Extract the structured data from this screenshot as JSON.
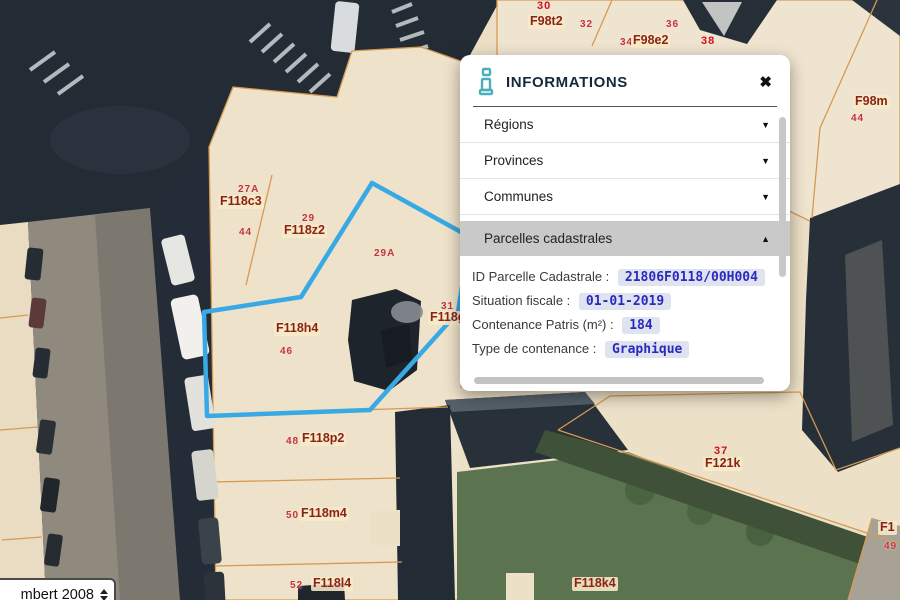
{
  "theme": {
    "selection_blue": "#38a9e4",
    "parcel_line": "#d69a52",
    "label_code_color": "#8b2219",
    "label_num_color": "#c23345",
    "panel_section_active_bg": "#c9c9c9",
    "badge_bg": "#dfe3f0",
    "badge_text": "#2a2abc",
    "info_icon_color": "#4aafbc"
  },
  "panel": {
    "title": "INFORMATIONS",
    "close_label": "✖",
    "sections": [
      {
        "label": "Régions",
        "state": "collapsed",
        "caret": "▼"
      },
      {
        "label": "Provinces",
        "state": "collapsed",
        "caret": "▼"
      },
      {
        "label": "Communes",
        "state": "collapsed",
        "caret": "▼"
      },
      {
        "label": "Parcelles cadastrales",
        "state": "expanded",
        "caret": "▲"
      }
    ],
    "details": [
      {
        "label": "ID Parcelle Cadastrale :",
        "value": "21806F0118/00H004"
      },
      {
        "label": "Situation fiscale :",
        "value": "01-01-2019"
      },
      {
        "label": "Contenance Patris (m²) :",
        "value": "184"
      },
      {
        "label": "Type de contenance :",
        "value": "Graphique"
      }
    ]
  },
  "map": {
    "projection_selector": {
      "value": "mbert 2008"
    },
    "selected_parcel_id": "21806F0118/00H004",
    "labels": [
      {
        "text": "30",
        "x": 537,
        "y": 0,
        "type": "num-bright"
      },
      {
        "text": "F98t2",
        "x": 528,
        "y": 15,
        "type": "code"
      },
      {
        "text": "32",
        "x": 580,
        "y": 19,
        "type": "num"
      },
      {
        "text": "36",
        "x": 666,
        "y": 19,
        "type": "num"
      },
      {
        "text": "34",
        "x": 620,
        "y": 37,
        "type": "num"
      },
      {
        "text": "F98e2",
        "x": 631,
        "y": 34,
        "type": "code"
      },
      {
        "text": "38",
        "x": 701,
        "y": 35,
        "type": "num-bright"
      },
      {
        "text": "F98m",
        "x": 853,
        "y": 95,
        "type": "code"
      },
      {
        "text": "44",
        "x": 851,
        "y": 113,
        "type": "num"
      },
      {
        "text": "27A",
        "x": 238,
        "y": 184,
        "type": "num"
      },
      {
        "text": "F118c3",
        "x": 218,
        "y": 195,
        "type": "code"
      },
      {
        "text": "29",
        "x": 302,
        "y": 213,
        "type": "num"
      },
      {
        "text": "F118z2",
        "x": 282,
        "y": 224,
        "type": "code"
      },
      {
        "text": "44",
        "x": 239,
        "y": 227,
        "type": "num"
      },
      {
        "text": "29A",
        "x": 374,
        "y": 248,
        "type": "num"
      },
      {
        "text": "31",
        "x": 441,
        "y": 301,
        "type": "num"
      },
      {
        "text": "F118g",
        "x": 428,
        "y": 311,
        "type": "code"
      },
      {
        "text": "F118h4",
        "x": 274,
        "y": 322,
        "type": "code"
      },
      {
        "text": "46",
        "x": 280,
        "y": 346,
        "type": "num"
      },
      {
        "text": "F118g2",
        "x": 536,
        "y": 378,
        "type": "code"
      },
      {
        "text": "48",
        "x": 286,
        "y": 436,
        "type": "num"
      },
      {
        "text": "F118p2",
        "x": 300,
        "y": 432,
        "type": "code"
      },
      {
        "text": "50",
        "x": 286,
        "y": 510,
        "type": "num"
      },
      {
        "text": "F118m4",
        "x": 299,
        "y": 507,
        "type": "code"
      },
      {
        "text": "52",
        "x": 290,
        "y": 580,
        "type": "num"
      },
      {
        "text": "F118l4",
        "x": 311,
        "y": 577,
        "type": "code"
      },
      {
        "text": "F118k4",
        "x": 572,
        "y": 577,
        "type": "code"
      },
      {
        "text": "37",
        "x": 714,
        "y": 445,
        "type": "num-bright"
      },
      {
        "text": "F121k",
        "x": 703,
        "y": 457,
        "type": "code"
      },
      {
        "text": "F1",
        "x": 878,
        "y": 521,
        "type": "code"
      },
      {
        "text": "49",
        "x": 884,
        "y": 541,
        "type": "num"
      }
    ]
  }
}
